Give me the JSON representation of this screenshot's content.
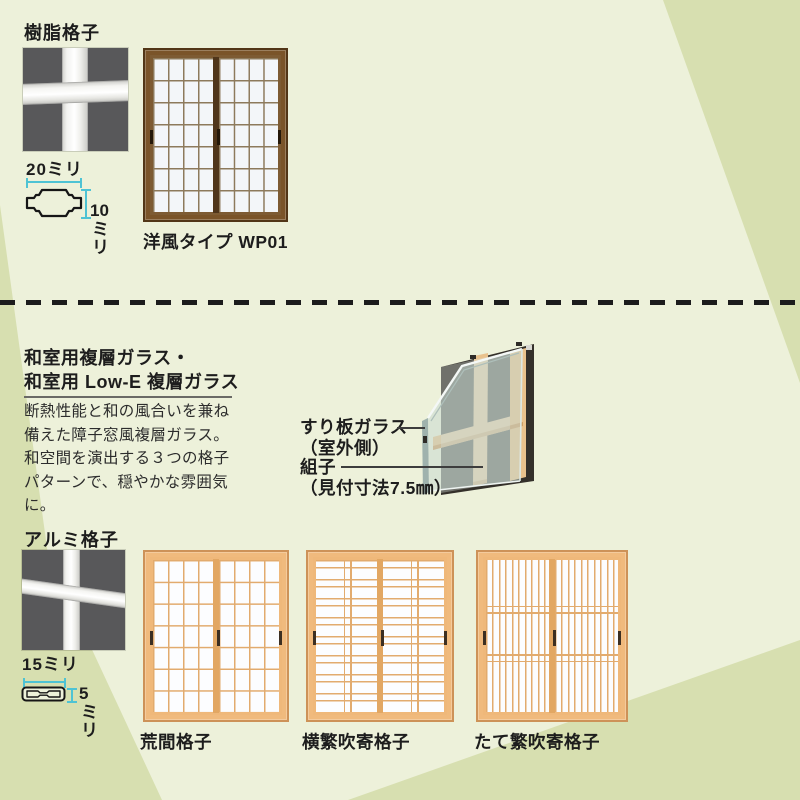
{
  "colors": {
    "background_light": "#edf1da",
    "background_dark": "#d7dfb0",
    "text": "#1d1d1d",
    "dimension_accent": "#4ec3d4",
    "dash_line": "#1c1c1c",
    "photo_background": "#58585a"
  },
  "top": {
    "heading": "樹脂格子",
    "dim_width": "20ミリ",
    "dim_height_value": "10",
    "dim_height_unit": "ミリ",
    "window_caption": "洋風タイプ WP01"
  },
  "mid": {
    "heading1": "和室用複層ガラス・",
    "heading2": "和室用 Low-E 複層ガラス",
    "body": "断熱性能と和の風合いを兼ね備えた障子窓風複層ガラス。和空間を演出する３つの格子パターンで、穏やかな雰囲気に。",
    "label_glass1": "すり板ガラス",
    "label_glass2": "（室外側）",
    "label_kumiko1": "組子",
    "label_kumiko2": "（見付寸法7.5㎜）"
  },
  "bottom": {
    "heading": "アルミ格子",
    "dim_width": "15ミリ",
    "dim_height_value": "5",
    "dim_height_unit": "ミリ",
    "windows": [
      {
        "caption": "荒間格子"
      },
      {
        "caption": "横繁吹寄格子"
      },
      {
        "caption": "たて繁吹寄格子"
      }
    ]
  },
  "illustrations": {
    "windows": {
      "wp01": {
        "x": 143,
        "y": 48,
        "w": 145,
        "h": 174,
        "colors": {
          "frame": "#7a5429",
          "frame_dark": "#523617",
          "sash": "#7d5b33",
          "mull": "#8d7a5c",
          "glass": "#f3f6f9",
          "stile": "#4f351a",
          "handle": "#241809"
        },
        "pattern": {
          "type": "grid",
          "cols": 4,
          "rows": 7
        },
        "handles": {
          "center": true,
          "sides": true
        }
      },
      "arama": {
        "x": 143,
        "y": 550,
        "w": 146,
        "h": 172,
        "colors": {
          "frame": "#f0ba7d",
          "frame_dark": "#cd9258",
          "sash": "#efb87a",
          "mull": "#e2ab6e",
          "glass": "#fcfdff",
          "stile": "#e2a763",
          "handle": "#3c2f22"
        },
        "pattern": {
          "type": "grid",
          "cols": 4,
          "rows": 7
        },
        "handles": {
          "center": true,
          "sides": true
        }
      },
      "yokoshige": {
        "x": 306,
        "y": 550,
        "w": 148,
        "h": 172,
        "colors": {
          "frame": "#f0ba7d",
          "frame_dark": "#cd9258",
          "sash": "#efb87a",
          "mull": "#e2ab6e",
          "glass": "#fcfdff",
          "stile": "#e2a763",
          "handle": "#3c2f22"
        },
        "pattern": {
          "type": "hpairs",
          "line": 1.4,
          "gap": 7,
          "period": 19,
          "vlines": [
            0.46,
            0.56
          ]
        },
        "handles": {
          "center": true,
          "sides": true
        }
      },
      "tateshige": {
        "x": 476,
        "y": 550,
        "w": 152,
        "h": 172,
        "colors": {
          "frame": "#f0ba7d",
          "frame_dark": "#cd9258",
          "sash": "#efb87a",
          "mull": "#e2ab6e",
          "glass": "#fcfdff",
          "stile": "#e2a763",
          "handle": "#3c2f22"
        },
        "pattern": {
          "type": "vpairs",
          "line": 1.3,
          "gap": 6,
          "period": 13,
          "hlines": [
            0.3,
            0.345,
            0.62,
            0.665
          ]
        },
        "handles": {
          "center": true,
          "sides": true
        }
      }
    }
  }
}
